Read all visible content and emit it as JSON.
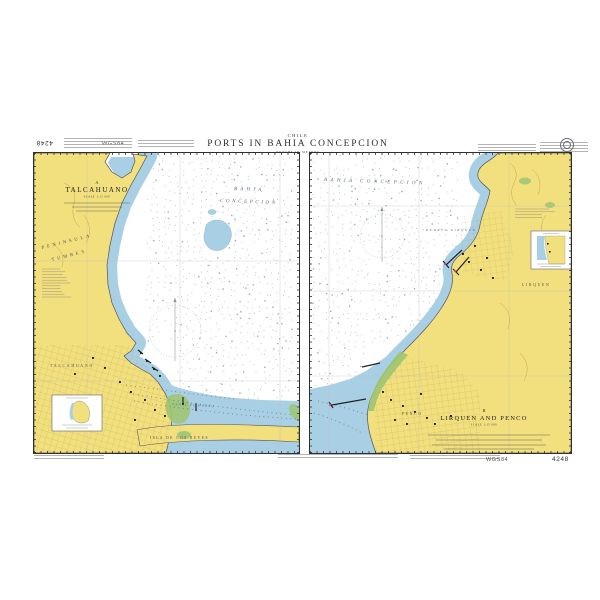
{
  "header": {
    "country": "CHILE",
    "title": "PORTS IN BAHIA CONCEPCION",
    "subtitle": "DEPTHS IN METRES"
  },
  "margin": {
    "sheet_number_top": "4248",
    "datum_top": "WGS84",
    "datum_bottom": "WGS84",
    "sheet_number_bottom": "4248"
  },
  "panel_a": {
    "designator": "A",
    "title": "TALCAHUANO",
    "scale_note": "SCALE 1:15 000",
    "sea_label_1": "BAHIA",
    "sea_label_2": "CONCEPCION",
    "peninsula_1": "PENINSULA",
    "peninsula_2": "TUMBES",
    "town": "TALCAHUANO",
    "island": "ISLA DE LOS REYES",
    "channel": "CANAL EL MORRO"
  },
  "panel_b": {
    "designator": "B",
    "title": "LIRQUEN AND PENCO",
    "scale_note": "SCALE 1:15 000",
    "sea_label": "BAHIA CONCEPCION",
    "port_label": "PUERTO LIRQUEN",
    "town_1": "LIRQUEN",
    "town_2": "PENCO"
  },
  "colors": {
    "land": "#f2df7e",
    "shallow": "#a9cfe5",
    "green": "#9dc573",
    "contour": "#c2a44e",
    "magenta": "#d8467d",
    "sounding": "#7e8ba0",
    "coast": "#555555"
  }
}
